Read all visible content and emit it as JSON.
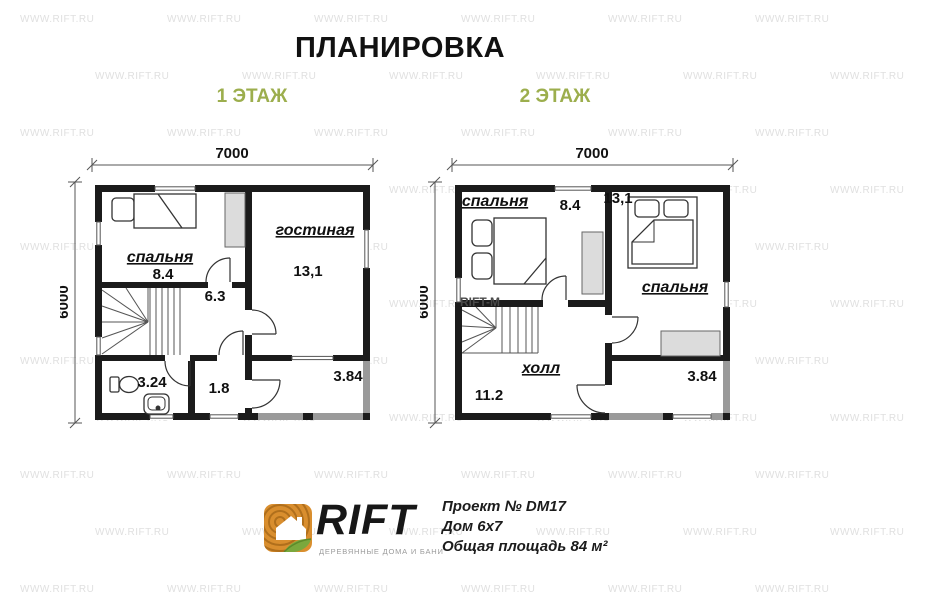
{
  "title": "ПЛАНИРОВКА",
  "colors": {
    "accent_green": "#9cae4d",
    "wall_black": "#1b1b1b",
    "wall_gray": "#9a9a9a",
    "closet_gray": "#dcdcdc",
    "watermark_gray": "#e0e0e0"
  },
  "watermark": {
    "text": "WWW.RIFT.RU"
  },
  "floor1": {
    "label": "1 ЭТАЖ",
    "dim_width": "7000",
    "dim_height": "6000",
    "rooms": {
      "bedroom": {
        "name": "спальня",
        "area": "8.4"
      },
      "living": {
        "name": "гостиная",
        "area": "13,1"
      },
      "hall": {
        "area": "6.3"
      },
      "bathroom": {
        "area": "3.24"
      },
      "entry": {
        "area": "1.8"
      },
      "terrace": {
        "area": "3.84"
      }
    }
  },
  "floor2": {
    "label": "2 ЭТАЖ",
    "dim_width": "7000",
    "dim_height": "6000",
    "plan_watermark": "RIFT-M",
    "rooms": {
      "bedroom_left": {
        "name": "спальня",
        "area": "8.4"
      },
      "bedroom_right": {
        "name": "спальня",
        "area": "13,1"
      },
      "hall": {
        "name": "холл",
        "area": "11.2"
      },
      "balcony": {
        "area": "3.84"
      }
    }
  },
  "footer": {
    "brand": "RIFT",
    "brand_tagline": "ДЕРЕВЯННЫЕ ДОМА И БАНИ",
    "project": "Проект № DM17",
    "house": "Дом 6х7",
    "total_area": "Общая площадь 84 м²"
  }
}
